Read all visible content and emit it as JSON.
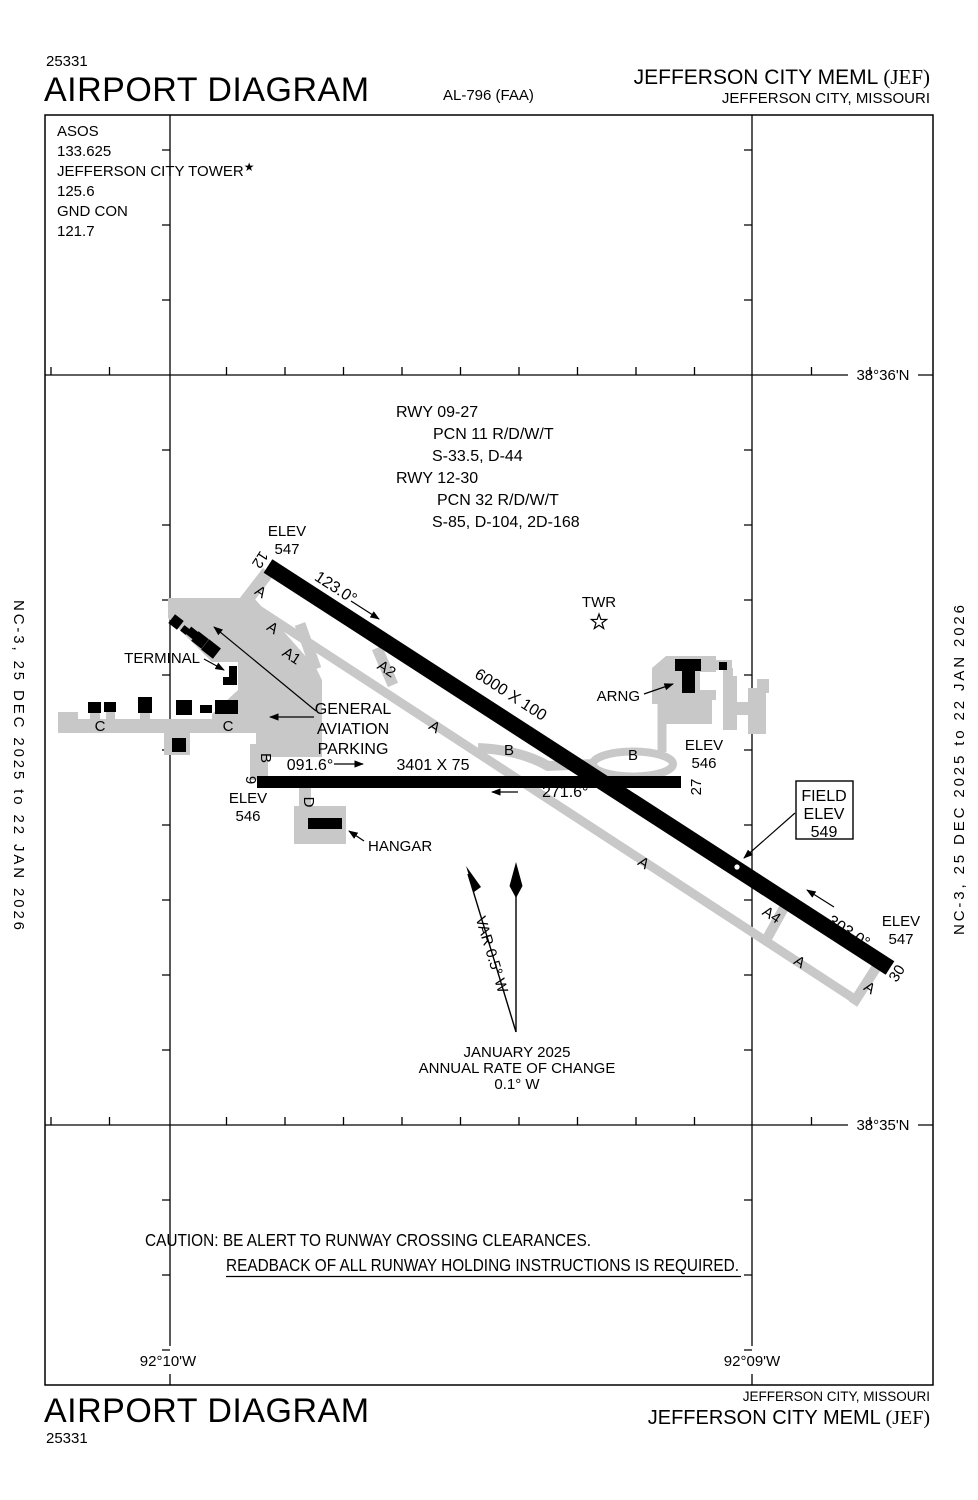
{
  "colors": {
    "ink": "#000000",
    "pavement": "#c8c8c8"
  },
  "header": {
    "chart_code": "25331",
    "title": "AIRPORT DIAGRAM",
    "procedure_id": "AL-796 (FAA)",
    "airport_name": "JEFFERSON CITY MEML ",
    "airport_code": "(JEF)",
    "city": "JEFFERSON CITY, MISSOURI"
  },
  "comm_box": {
    "asos_label": "ASOS",
    "asos_freq": "133.625",
    "tower_label": "JEFFERSON CITY TOWER",
    "tower_star": "★",
    "tower_freq": "125.6",
    "gnd_label": "GND CON",
    "gnd_freq": "121.7"
  },
  "runway_data": {
    "rwy0927_label": "RWY 09-27",
    "rwy0927_pcn": "PCN 11 R/D/W/T",
    "rwy0927_strength": "S-33.5, D-44",
    "rwy1230_label": "RWY 12-30",
    "rwy1230_pcn": "PCN 32 R/D/W/T",
    "rwy1230_strength": "S-85, D-104, 2D-168"
  },
  "grid": {
    "lat_top": "38°36'N",
    "lat_bottom": "38°35'N",
    "lon_left": "92°10'W",
    "lon_right": "92°09'W"
  },
  "side_note": "NC-3,  25 DEC 2025  to  22 JAN 2026",
  "diagram": {
    "rwy12": "12",
    "rwy30": "30",
    "rwy9": "9",
    "rwy27": "27",
    "hdg_12": "123.0°",
    "hdg_30": "303.0°",
    "hdg_9": "091.6°",
    "hdg_27": "271.6°",
    "rwy1230_dim": "6000 X 100",
    "rwy0927_dim": "3401 X 75",
    "elev_label": "ELEV",
    "elev_12": "547",
    "elev_9": "546",
    "elev_27": "546",
    "elev_30": "547",
    "field_elev": {
      "line1": "FIELD",
      "line2": "ELEV",
      "line3": "549"
    },
    "twr_label": "TWR",
    "twr_star": "☆",
    "arng_label": "ARNG",
    "terminal_label": "TERMINAL",
    "ga_parking": {
      "line1": "GENERAL",
      "line2": "AVIATION",
      "line3": "PARKING"
    },
    "hangar_label": "HANGAR",
    "twy_a": "A",
    "twy_a1": "A1",
    "twy_a2": "A2",
    "twy_a4": "A4",
    "twy_b": "B",
    "twy_c": "C",
    "twy_d": "D",
    "var_label": "VAR 0.5° W",
    "mag_note": {
      "line1": "JANUARY 2025",
      "line2": "ANNUAL RATE OF CHANGE",
      "line3": "0.1° W"
    }
  },
  "caution": {
    "line1": "CAUTION: BE ALERT TO RUNWAY CROSSING CLEARANCES.",
    "line2": "READBACK OF ALL RUNWAY HOLDING INSTRUCTIONS IS REQUIRED."
  },
  "footer": {
    "city": "JEFFERSON CITY, MISSOURI",
    "airport_name": "JEFFERSON CITY MEML ",
    "airport_code": "(JEF)",
    "title": "AIRPORT DIAGRAM",
    "chart_code": "25331"
  }
}
